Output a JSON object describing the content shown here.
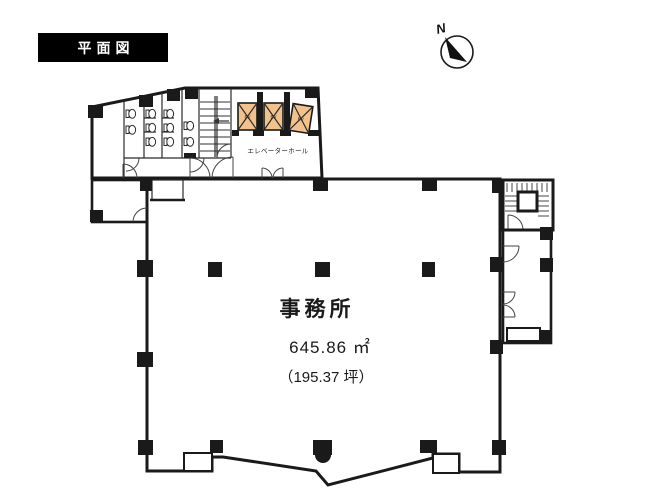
{
  "page": {
    "title": "平面図"
  },
  "compass": {
    "north": "N"
  },
  "plan": {
    "office": {
      "label": "事務所",
      "area_m2": "645.86 ㎡",
      "area_tsubo": "（195.37 坪）"
    },
    "elevator_hall": {
      "label": "エレベーターホール"
    },
    "elevators": {
      "labels": [
        "EV",
        "EV",
        "EV"
      ]
    }
  },
  "colors": {
    "pink": "#f2b5ad",
    "orange": "#f2c28c",
    "wall": "#1a1a1a"
  }
}
